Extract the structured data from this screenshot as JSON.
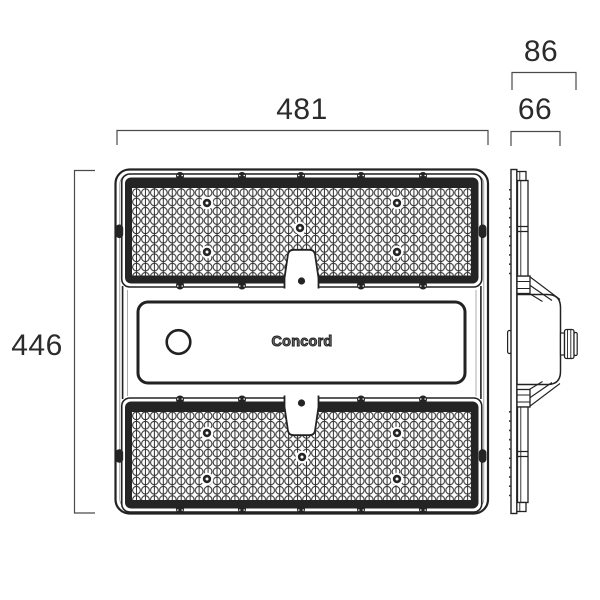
{
  "drawing": {
    "brand_label": "Concord",
    "dimensions": {
      "front_width": "481",
      "front_height": "446",
      "side_overall_depth": "86",
      "side_body_depth": "66"
    },
    "colors": {
      "outline": "#222222",
      "panel_frame": "#242424",
      "dimension_line": "#4a4a4a",
      "dimension_text": "#2b2b2b"
    }
  }
}
